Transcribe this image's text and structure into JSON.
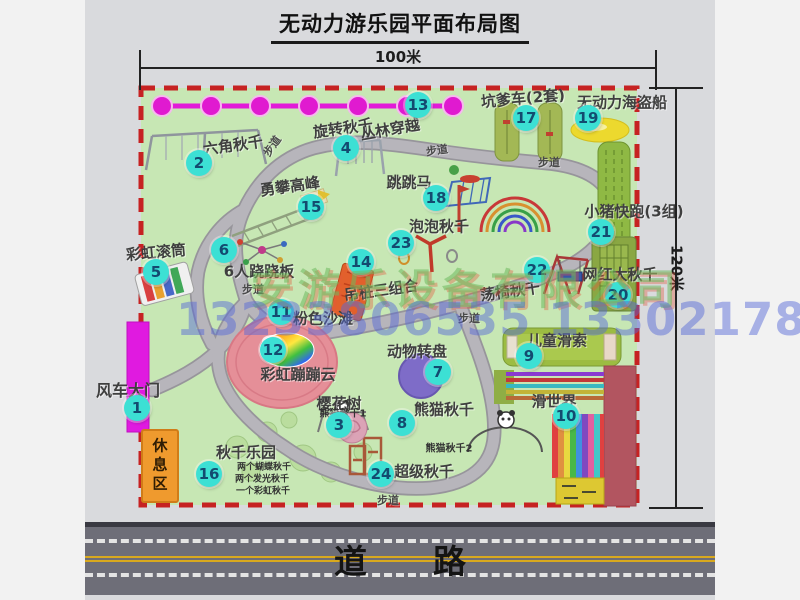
{
  "title": "无动力游乐园平面布局图",
  "measurements": {
    "width": "100米",
    "height": "120米"
  },
  "road": {
    "label": "道　　路"
  },
  "watermarks": {
    "company": "安游乐设备有限公司",
    "phone": "13233806535 13302178333"
  },
  "rest_area": {
    "label": "休息区"
  },
  "walkway_label": "步道",
  "colors": {
    "park_green": "#c7e7b4",
    "border_red": "#c62222",
    "badge_teal": "#3ce0d4",
    "gate_magenta": "#e01ae0",
    "road_gray": "#6e6e78"
  },
  "attractions": [
    {
      "num": "1",
      "name": "风车大门",
      "badge": {
        "x": 137,
        "y": 408
      },
      "label": {
        "x": 128,
        "y": 389,
        "rot": 0,
        "fs": 16
      }
    },
    {
      "num": "2",
      "name": "六角秋千",
      "badge": {
        "x": 199,
        "y": 163
      },
      "label": {
        "x": 233,
        "y": 145,
        "rot": -8,
        "fs": 15
      }
    },
    {
      "num": "3",
      "name": "樱花树",
      "badge": {
        "x": 339,
        "y": 425
      },
      "label": {
        "x": 339,
        "y": 403,
        "rot": 0,
        "fs": 15
      }
    },
    {
      "num": "4",
      "name": "旋转秋千",
      "badge": {
        "x": 346,
        "y": 148
      },
      "label": {
        "x": 343,
        "y": 128,
        "rot": -8,
        "fs": 15
      }
    },
    {
      "num": "5",
      "name": "彩虹滚筒",
      "badge": {
        "x": 156,
        "y": 272
      },
      "label": {
        "x": 156,
        "y": 252,
        "rot": -5,
        "fs": 15
      }
    },
    {
      "num": "6",
      "name": "6人跷跷板",
      "badge": {
        "x": 224,
        "y": 250
      },
      "label": {
        "x": 259,
        "y": 271,
        "rot": 0,
        "fs": 15
      }
    },
    {
      "num": "7",
      "name": "动物转盘",
      "badge": {
        "x": 438,
        "y": 372
      },
      "label": {
        "x": 417,
        "y": 351,
        "rot": 0,
        "fs": 15
      }
    },
    {
      "num": "8",
      "name": "熊猫秋千",
      "badge": {
        "x": 402,
        "y": 423
      },
      "label": {
        "x": 444,
        "y": 409,
        "rot": 0,
        "fs": 15
      }
    },
    {
      "num": "9",
      "name": "儿童滑索",
      "badge": {
        "x": 529,
        "y": 356
      },
      "label": {
        "x": 557,
        "y": 340,
        "rot": 0,
        "fs": 15
      }
    },
    {
      "num": "10",
      "name": "滑世界",
      "badge": {
        "x": 566,
        "y": 416
      },
      "label": {
        "x": 554,
        "y": 401,
        "rot": 0,
        "fs": 15
      }
    },
    {
      "num": "11",
      "name": "粉色沙滩",
      "badge": {
        "x": 281,
        "y": 312
      },
      "label": {
        "x": 323,
        "y": 318,
        "rot": 0,
        "fs": 15
      }
    },
    {
      "num": "12",
      "name": "彩虹蹦蹦云",
      "badge": {
        "x": 273,
        "y": 350
      },
      "label": {
        "x": 298,
        "y": 374,
        "rot": 0,
        "fs": 15
      }
    },
    {
      "num": "13",
      "name": "丛林穿越",
      "badge": {
        "x": 418,
        "y": 105
      },
      "label": {
        "x": 390,
        "y": 129,
        "rot": -10,
        "fs": 15
      }
    },
    {
      "num": "14",
      "name": "吊桩三组合",
      "badge": {
        "x": 361,
        "y": 262
      },
      "label": {
        "x": 381,
        "y": 290,
        "rot": -8,
        "fs": 15
      }
    },
    {
      "num": "15",
      "name": "勇攀高峰",
      "badge": {
        "x": 311,
        "y": 207
      },
      "label": {
        "x": 290,
        "y": 186,
        "rot": -8,
        "fs": 15
      }
    },
    {
      "num": "16",
      "name": "秋千乐园",
      "badge": {
        "x": 209,
        "y": 474
      },
      "label": {
        "x": 246,
        "y": 452,
        "rot": 0,
        "fs": 15
      }
    },
    {
      "num": "17",
      "name": "坑爹车(2套)",
      "badge": {
        "x": 526,
        "y": 118
      },
      "label": {
        "x": 523,
        "y": 98,
        "rot": -5,
        "fs": 15
      }
    },
    {
      "num": "18",
      "name": "跳跳马",
      "badge": {
        "x": 436,
        "y": 198
      },
      "label": {
        "x": 409,
        "y": 182,
        "rot": 0,
        "fs": 15
      }
    },
    {
      "num": "19",
      "name": "无动力海盗船",
      "badge": {
        "x": 588,
        "y": 118
      },
      "label": {
        "x": 622,
        "y": 102,
        "rot": 0,
        "fs": 15
      }
    },
    {
      "num": "20",
      "name": "网红大秋千",
      "badge": {
        "x": 618,
        "y": 295
      },
      "label": {
        "x": 620,
        "y": 274,
        "rot": 0,
        "fs": 15
      }
    },
    {
      "num": "21",
      "name": "小猪快跑(3组)",
      "badge": {
        "x": 601,
        "y": 232
      },
      "label": {
        "x": 634,
        "y": 211,
        "rot": 0,
        "fs": 15
      }
    },
    {
      "num": "22",
      "name": "荡椅秋千",
      "badge": {
        "x": 537,
        "y": 270
      },
      "label": {
        "x": 510,
        "y": 291,
        "rot": -8,
        "fs": 15
      }
    },
    {
      "num": "23",
      "name": "泡泡秋千",
      "badge": {
        "x": 401,
        "y": 243
      },
      "label": {
        "x": 439,
        "y": 226,
        "rot": 0,
        "fs": 15
      }
    },
    {
      "num": "24",
      "name": "超级秋千",
      "badge": {
        "x": 381,
        "y": 474
      },
      "label": {
        "x": 424,
        "y": 471,
        "rot": 0,
        "fs": 15
      }
    }
  ],
  "sub_labels": [
    {
      "text": "熊猫秋千1",
      "x": 343,
      "y": 412,
      "fs": 10
    },
    {
      "text": "熊猫秋千2",
      "x": 449,
      "y": 447,
      "fs": 10
    },
    {
      "text": "两个蝴蝶秋千",
      "x": 264,
      "y": 466,
      "fs": 9
    },
    {
      "text": "两个发光秋千",
      "x": 262,
      "y": 478,
      "fs": 9
    },
    {
      "text": "一个彩虹秋千",
      "x": 263,
      "y": 490,
      "fs": 9
    }
  ],
  "walkway_labels": [
    {
      "x": 272,
      "y": 146,
      "rot": -55
    },
    {
      "x": 437,
      "y": 150,
      "rot": -8
    },
    {
      "x": 549,
      "y": 162,
      "rot": 0
    },
    {
      "x": 253,
      "y": 289,
      "rot": 0
    },
    {
      "x": 469,
      "y": 318,
      "rot": 0
    },
    {
      "x": 388,
      "y": 500,
      "rot": 0
    }
  ]
}
